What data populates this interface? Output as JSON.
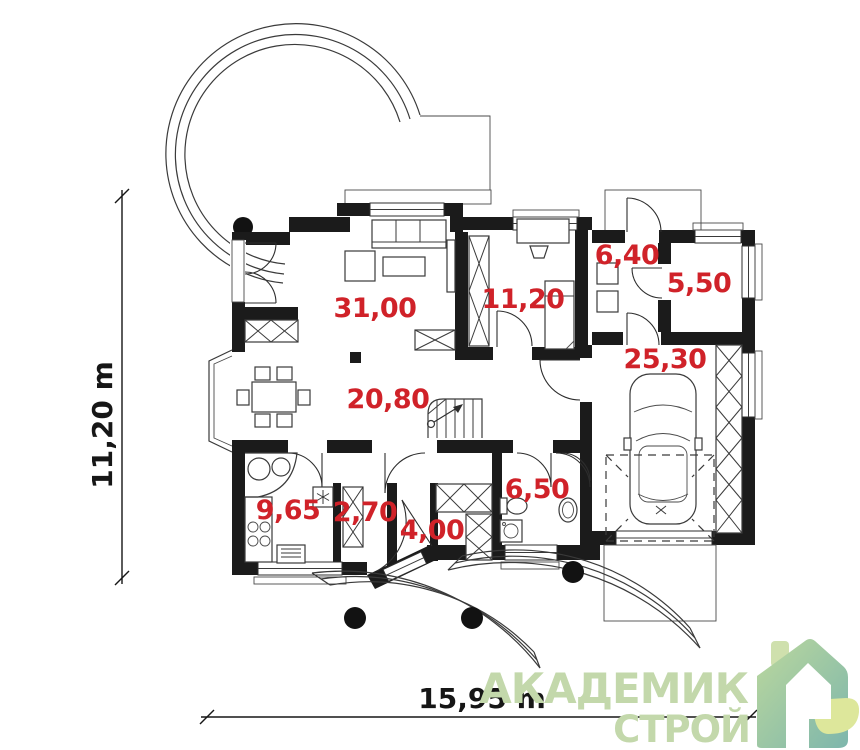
{
  "plan": {
    "type": "floor-plan",
    "rooms": [
      {
        "id": "living-room",
        "area": "31,00"
      },
      {
        "id": "dining-hall",
        "area": "20,80"
      },
      {
        "id": "bedroom",
        "area": "11,20"
      },
      {
        "id": "utility-room",
        "area": "6,40"
      },
      {
        "id": "storage-room",
        "area": "5,50"
      },
      {
        "id": "garage",
        "area": "25,30"
      },
      {
        "id": "kitchen",
        "area": "9,65"
      },
      {
        "id": "pantry",
        "area": "2,70"
      },
      {
        "id": "entry-hall",
        "area": "4,00"
      },
      {
        "id": "bathroom",
        "area": "6,50"
      }
    ],
    "dimensions": {
      "width_label": "15,95 m",
      "height_label": "11,20 m"
    },
    "colors": {
      "room_label": "#d02229",
      "walls": "#1b1b1b",
      "lines": "#3a3a3a",
      "dimension_text": "#161616"
    }
  },
  "logo": {
    "line1": "АКАДЕМИК",
    "line2": "СТРОЙ",
    "text_color": "#c3d8ab",
    "house_gradient_top": "#bcd89d",
    "house_gradient_bottom": "#7db6ac",
    "leaf_color": "#dde79b",
    "chimney_color": "#cfe0ad"
  }
}
